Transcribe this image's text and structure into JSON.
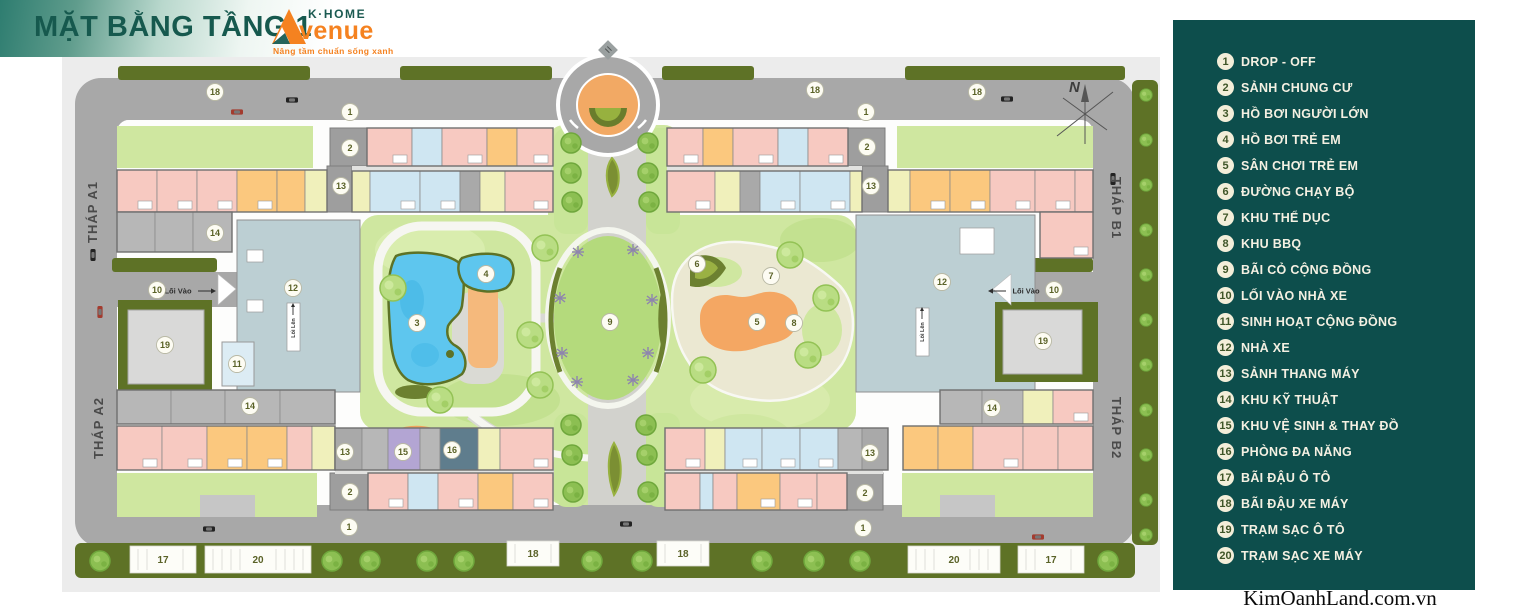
{
  "header": {
    "title": "MẶT BẰNG TẦNG 1",
    "logo": {
      "brand_top": "K·HOME",
      "brand_script": "venue",
      "tagline": "Nâng tầm chuẩn sống xanh"
    }
  },
  "legend": {
    "items": [
      {
        "num": 1,
        "label": "DROP - OFF"
      },
      {
        "num": 2,
        "label": "SẢNH CHUNG CƯ"
      },
      {
        "num": 3,
        "label": "HỒ BƠI NGƯỜI LỚN"
      },
      {
        "num": 4,
        "label": "HỒ BƠI TRẺ EM"
      },
      {
        "num": 5,
        "label": "SÂN CHƠI TRẺ EM"
      },
      {
        "num": 6,
        "label": "ĐƯỜNG CHẠY BỘ"
      },
      {
        "num": 7,
        "label": "KHU THỂ DỤC"
      },
      {
        "num": 8,
        "label": "KHU BBQ"
      },
      {
        "num": 9,
        "label": "BÃI CỎ CỘNG ĐỒNG"
      },
      {
        "num": 10,
        "label": "LỐI VÀO NHÀ XE"
      },
      {
        "num": 11,
        "label": "SINH HOẠT CỘNG ĐỒNG"
      },
      {
        "num": 12,
        "label": "NHÀ XE"
      },
      {
        "num": 13,
        "label": "SẢNH THANG MÁY"
      },
      {
        "num": 14,
        "label": "KHU KỸ THUẬT"
      },
      {
        "num": 15,
        "label": "KHU VỆ SINH & THAY ĐỒ"
      },
      {
        "num": 16,
        "label": "PHÒNG ĐA NĂNG"
      },
      {
        "num": 17,
        "label": "BÃI ĐẬU Ô TÔ"
      },
      {
        "num": 18,
        "label": "BÃI ĐẬU XE MÁY"
      },
      {
        "num": 19,
        "label": "TRẠM SẠC Ô TÔ"
      },
      {
        "num": 20,
        "label": "TRẠM SẠC XE MÁY"
      }
    ]
  },
  "watermark": "KimOanhLand.com.vn",
  "plan": {
    "compass": "N",
    "tower_labels": [
      {
        "text": "THÁP A1",
        "x": 97,
        "y": 212,
        "rot": -90
      },
      {
        "text": "THÁP A2",
        "x": 103,
        "y": 428,
        "rot": -90
      },
      {
        "text": "THÁP B1",
        "x": 1112,
        "y": 208,
        "rot": 90
      },
      {
        "text": "THÁP B2",
        "x": 1112,
        "y": 428,
        "rot": 90
      }
    ],
    "markers": [
      {
        "n": 18,
        "x": 215,
        "y": 92
      },
      {
        "n": 1,
        "x": 350,
        "y": 112
      },
      {
        "n": 18,
        "x": 815,
        "y": 90
      },
      {
        "n": 18,
        "x": 977,
        "y": 92
      },
      {
        "n": 1,
        "x": 866,
        "y": 112
      },
      {
        "n": 2,
        "x": 350,
        "y": 148
      },
      {
        "n": 13,
        "x": 341,
        "y": 186
      },
      {
        "n": 14,
        "x": 215,
        "y": 233
      },
      {
        "n": 10,
        "x": 157,
        "y": 290
      },
      {
        "n": 12,
        "x": 293,
        "y": 288
      },
      {
        "n": 19,
        "x": 165,
        "y": 345
      },
      {
        "n": 11,
        "x": 237,
        "y": 364
      },
      {
        "n": 14,
        "x": 250,
        "y": 406
      },
      {
        "n": 13,
        "x": 345,
        "y": 452
      },
      {
        "n": 15,
        "x": 403,
        "y": 452
      },
      {
        "n": 16,
        "x": 452,
        "y": 450
      },
      {
        "n": 2,
        "x": 350,
        "y": 492
      },
      {
        "n": 1,
        "x": 349,
        "y": 527
      },
      {
        "n": 3,
        "x": 417,
        "y": 323
      },
      {
        "n": 4,
        "x": 486,
        "y": 274
      },
      {
        "n": 9,
        "x": 610,
        "y": 322
      },
      {
        "n": 6,
        "x": 697,
        "y": 264
      },
      {
        "n": 7,
        "x": 771,
        "y": 276
      },
      {
        "n": 5,
        "x": 757,
        "y": 322
      },
      {
        "n": 8,
        "x": 794,
        "y": 323
      },
      {
        "n": 2,
        "x": 867,
        "y": 147
      },
      {
        "n": 13,
        "x": 871,
        "y": 186
      },
      {
        "n": 12,
        "x": 942,
        "y": 282
      },
      {
        "n": 10,
        "x": 1054,
        "y": 290
      },
      {
        "n": 19,
        "x": 1043,
        "y": 341
      },
      {
        "n": 14,
        "x": 992,
        "y": 408
      },
      {
        "n": 13,
        "x": 870,
        "y": 453
      },
      {
        "n": 2,
        "x": 865,
        "y": 493
      },
      {
        "n": 1,
        "x": 863,
        "y": 528
      }
    ],
    "parking_boxes": [
      {
        "num": 17,
        "x": 130,
        "y": 546,
        "w": 66,
        "h": 27
      },
      {
        "num": 20,
        "x": 205,
        "y": 546,
        "w": 106,
        "h": 27
      },
      {
        "num": 18,
        "x": 507,
        "y": 541,
        "w": 52,
        "h": 25
      },
      {
        "num": 18,
        "x": 657,
        "y": 541,
        "w": 52,
        "h": 25
      },
      {
        "num": 20,
        "x": 908,
        "y": 546,
        "w": 92,
        "h": 27
      },
      {
        "num": 17,
        "x": 1018,
        "y": 546,
        "w": 66,
        "h": 27
      }
    ],
    "road_labels": [
      {
        "text": "Lối Vào",
        "x": 178,
        "y": 291,
        "dir": "right"
      },
      {
        "text": "Lối Vào",
        "x": 1026,
        "y": 291,
        "dir": "left"
      }
    ],
    "ramp_labels": [
      {
        "text": "Lối Lên",
        "x": 293,
        "y": 328
      },
      {
        "text": "Lối Lên",
        "x": 922,
        "y": 332
      }
    ]
  },
  "colors": {
    "accent_teal": "#16594e",
    "logo_orange": "#f58220",
    "legend_bg": "#0d4e4c",
    "legend_text": "#f4f0e2",
    "legend_circle": "#f3eed9",
    "legend_num": "#3f5528",
    "road": "#a8a8a8",
    "hedge": "#5e7226",
    "park": "#cfe7a0",
    "pool": "#5ec6ee",
    "playground": "#f4a763",
    "track": "#ebe8d2",
    "garage": "#bccfd3",
    "marker_num": "#5a6227",
    "unit_pink": "#f7c9c1",
    "unit_orange": "#fbc87e",
    "unit_blue": "#cfe6f2",
    "unit_yellow": "#f0f0bb",
    "unit_purple": "#b3a5d3",
    "unit_slate": "#5f7d8d",
    "unit_gray": "#a9a9a9",
    "unit_gray2": "#b7b7b7"
  }
}
